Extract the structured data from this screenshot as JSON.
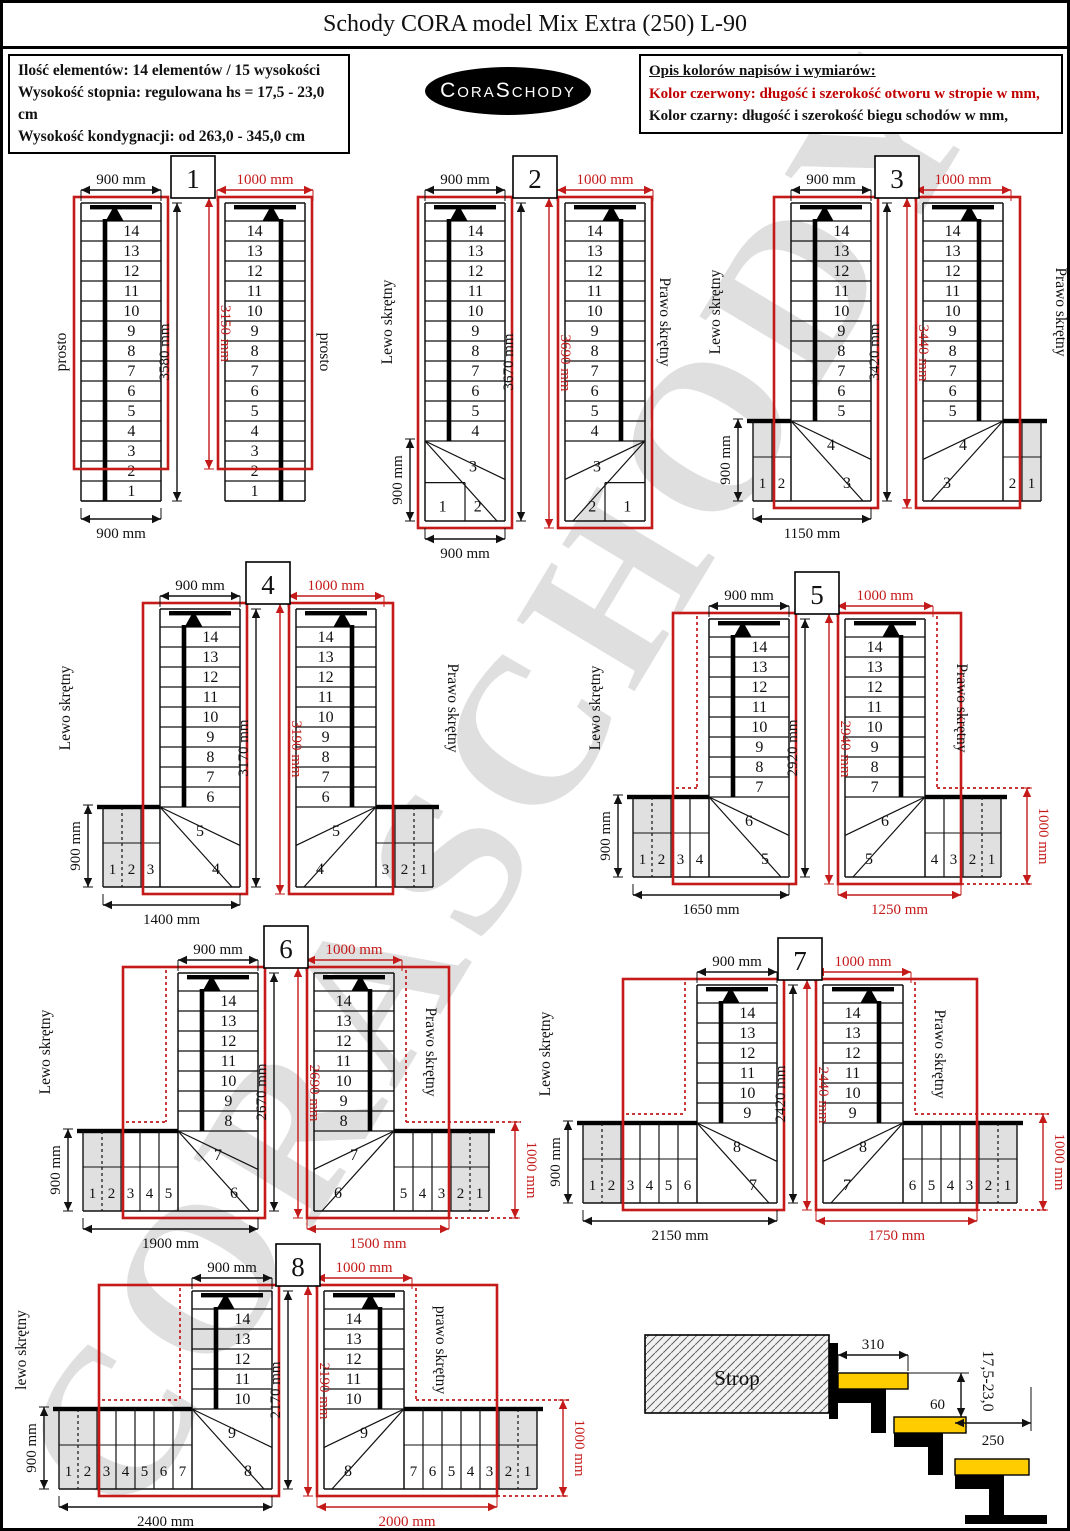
{
  "page": {
    "title": "Schody CORA model Mix Extra (250) L-90"
  },
  "header": {
    "info_lines": [
      "Ilość elementów: 14 elementów / 15 wysokości",
      "Wysokość stopnia: regulowana  hs = 17,5 - 23,0 cm",
      "Wysokość kondygnacji: od 263,0 - 345,0 cm"
    ],
    "logo_text": "CoraSchody",
    "legend_title": "Opis kolorów napisów i wymiarów:",
    "legend_red": "Kolor czerwony:  długość i szerokość otworu w stropie w mm,",
    "legend_black": "Kolor czarny:  długość i szerokość biegu schodów w mm,"
  },
  "watermark": "CORASCHODY",
  "colors": {
    "red": "#c41a1a",
    "black": "#111111",
    "gray": "#e0e0e0",
    "yellow": "#ffcc00"
  },
  "diagrams": [
    {
      "number": "1",
      "type": "straight",
      "left_label": "prosto",
      "right_label": "prosto",
      "column_steps": [
        14,
        13,
        12,
        11,
        10,
        9,
        8,
        7,
        6,
        5,
        4,
        3,
        2,
        1
      ],
      "top_dim_black": "900 mm",
      "top_dim_red": "1000 mm",
      "height_dim_black": "3580 mm",
      "height_dim_red": "3150 mm",
      "bottom_dim_black": "900 mm",
      "layout": {
        "x": 52,
        "y": 150,
        "gap": 64
      }
    },
    {
      "number": "2",
      "type": "corner",
      "left_label": "Lewo skrętny",
      "right_label": "Prawo skrętny",
      "column_steps": [
        14,
        13,
        12,
        11,
        10,
        9,
        8,
        7,
        6,
        5,
        4
      ],
      "corner_steps": [
        3,
        2,
        1
      ],
      "top_dim_black": "900 mm",
      "top_dim_red": "1000 mm",
      "height_dim_black": "3670 mm",
      "height_dim_red": "3690 mm",
      "bottom_dim_black": "900 mm",
      "side_dim_black": "900 mm",
      "layout": {
        "x": 378,
        "y": 150,
        "gap": 60
      }
    },
    {
      "number": "3",
      "type": "L",
      "left_label": "Lewo skrętny",
      "right_label": "Prawo skrętny",
      "column_steps": [
        14,
        13,
        12,
        11,
        10,
        9,
        8,
        7,
        6,
        5
      ],
      "winder_steps": [
        4,
        3
      ],
      "landing_steps": [
        1,
        2
      ],
      "gray_steps": 1,
      "top_dim_black": "900 mm",
      "top_dim_red": "1000 mm",
      "height_dim_black": "3420 mm",
      "height_dim_red": "3440 mm",
      "bottom_dim_black": "1150 mm",
      "side_dim_black": "900 mm",
      "layout": {
        "x": 706,
        "y": 150,
        "gap": 52,
        "rm": 24
      }
    },
    {
      "number": "4",
      "type": "L",
      "left_label": "Lewo skrętny",
      "right_label": "Prawo skrętny",
      "column_steps": [
        14,
        13,
        12,
        11,
        10,
        9,
        8,
        7,
        6
      ],
      "winder_steps": [
        5,
        4
      ],
      "landing_steps": [
        1,
        2,
        3
      ],
      "gray_steps": 2,
      "top_dim_black": "900 mm",
      "top_dim_red": "1000 mm",
      "height_dim_black": "3170 mm",
      "height_dim_red": "3190 mm",
      "bottom_dim_black": "1400 mm",
      "side_dim_black": "900 mm",
      "layout": {
        "x": 56,
        "y": 556,
        "gap": 56
      }
    },
    {
      "number": "5",
      "type": "L",
      "left_label": "Lewo skrętny",
      "right_label": "Prawo skrętny",
      "column_steps": [
        14,
        13,
        12,
        11,
        10,
        9,
        8,
        7
      ],
      "winder_steps": [
        6,
        5
      ],
      "landing_steps": [
        1,
        2,
        3,
        4
      ],
      "gray_steps": 2,
      "top_dim_black": "900 mm",
      "top_dim_red": "1000 mm",
      "height_dim_black": "2920 mm",
      "height_dim_red": "2940 mm",
      "bottom_dim_black": "1650 mm",
      "bottom_dim_red": "1250 mm",
      "side_dim_black": "900 mm",
      "side_dim_red": "1000 mm",
      "layout": {
        "x": 586,
        "y": 566,
        "gap": 56
      }
    },
    {
      "number": "6",
      "type": "L",
      "left_label": "Lewo skrętny",
      "right_label": "Prawo skrętny",
      "column_steps": [
        14,
        13,
        12,
        11,
        10,
        9,
        8
      ],
      "winder_steps": [
        7,
        6
      ],
      "landing_steps": [
        1,
        2,
        3,
        4,
        5
      ],
      "gray_steps": 2,
      "top_dim_black": "900 mm",
      "top_dim_red": "1000 mm",
      "height_dim_black": "2670 mm",
      "height_dim_red": "2690 mm",
      "bottom_dim_black": "1900 mm",
      "bottom_dim_red": "1500 mm",
      "side_dim_black": "900 mm",
      "side_dim_red": "1000 mm",
      "layout": {
        "x": 36,
        "y": 920,
        "gap": 56
      }
    },
    {
      "number": "7",
      "type": "L",
      "left_label": "Lewo skrętny",
      "right_label": "Prawo skrętny",
      "column_steps": [
        14,
        13,
        12,
        11,
        10,
        9
      ],
      "winder_steps": [
        8,
        7
      ],
      "landing_steps": [
        1,
        2,
        3,
        4,
        5,
        6
      ],
      "gray_steps": 2,
      "top_dim_black": "900 mm",
      "top_dim_red": "1000 mm",
      "height_dim_black": "2420 mm",
      "height_dim_red": "2440 mm",
      "bottom_dim_black": "2150 mm",
      "bottom_dim_red": "1750 mm",
      "side_dim_black": "900 mm",
      "side_dim_red": "1000 mm",
      "layout": {
        "x": 536,
        "y": 932,
        "gap": 46,
        "rm": 48
      }
    },
    {
      "number": "8",
      "type": "L",
      "left_label": "lewo skrętny",
      "right_label": "prawo skrętny",
      "column_steps": [
        14,
        13,
        12,
        11,
        10
      ],
      "winder_steps": [
        9,
        8
      ],
      "landing_steps": [
        1,
        2,
        3,
        4,
        5,
        6,
        7
      ],
      "gray_steps": 2,
      "top_dim_black": "900 mm",
      "top_dim_red": "1000 mm",
      "height_dim_black": "2170 mm",
      "height_dim_red": "2190 mm",
      "bottom_dim_black": "2400 mm",
      "bottom_dim_red": "2000 mm",
      "side_dim_black": "900 mm",
      "side_dim_red": "1000 mm",
      "layout": {
        "x": 12,
        "y": 1238,
        "gap": 52
      }
    }
  ],
  "strop": {
    "label": "Strop",
    "dim_tread_overlap": "310",
    "dim_riser": "60",
    "dim_step_height_range": "17,5-23,0",
    "dim_tread_depth": "250",
    "layout": {
      "x": 628,
      "y": 1286
    }
  }
}
